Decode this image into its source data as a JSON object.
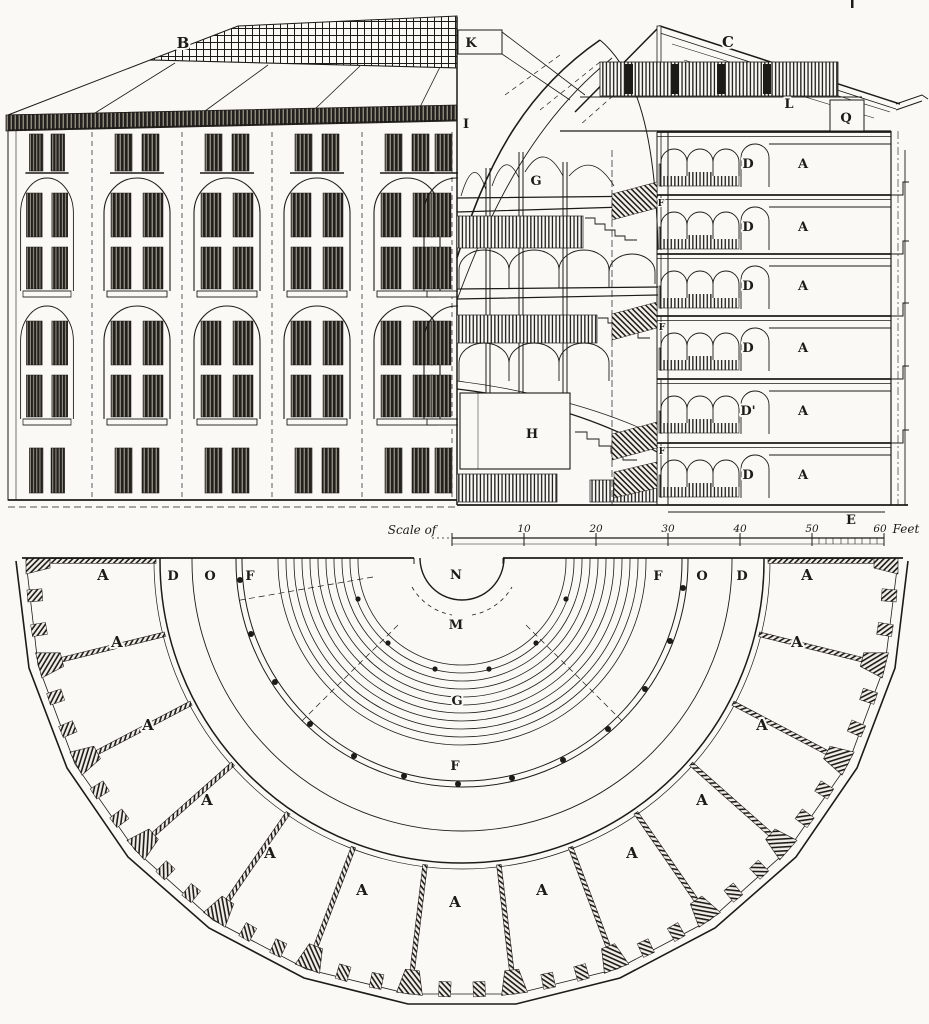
{
  "palette": {
    "ink": "#1d1b17",
    "paper": "#faf9f6"
  },
  "elevation": {
    "roof_label": "B"
  },
  "section": {
    "labels": {
      "k": "K",
      "c": "C",
      "i": "I",
      "l": "L",
      "q": "Q",
      "g": "G",
      "h": "H",
      "e": "E"
    },
    "cell_rows": [
      {
        "d": "D",
        "a": "A"
      },
      {
        "d": "D",
        "a": "A"
      },
      {
        "d": "D",
        "a": "A"
      },
      {
        "d": "D",
        "a": "A"
      },
      {
        "d": "D'",
        "a": "A"
      },
      {
        "d": "D",
        "a": "A"
      }
    ],
    "stair_labels": [
      "F",
      "F",
      "F"
    ]
  },
  "scale_bar": {
    "caption": "Scale of",
    "ticks": [
      "10",
      "20",
      "30",
      "40",
      "50",
      "60"
    ],
    "unit": "Feet"
  },
  "plan": {
    "center_labels": {
      "n": "N",
      "m": "M",
      "g": "G",
      "f": "F"
    },
    "left_labels": [
      "D",
      "O",
      "F"
    ],
    "right_labels": [
      "F",
      "O",
      "D"
    ],
    "cell_labels": [
      "A",
      "A",
      "A",
      "A",
      "A",
      "A",
      "A",
      "A",
      "A",
      "A",
      "A",
      "A",
      "A"
    ]
  }
}
